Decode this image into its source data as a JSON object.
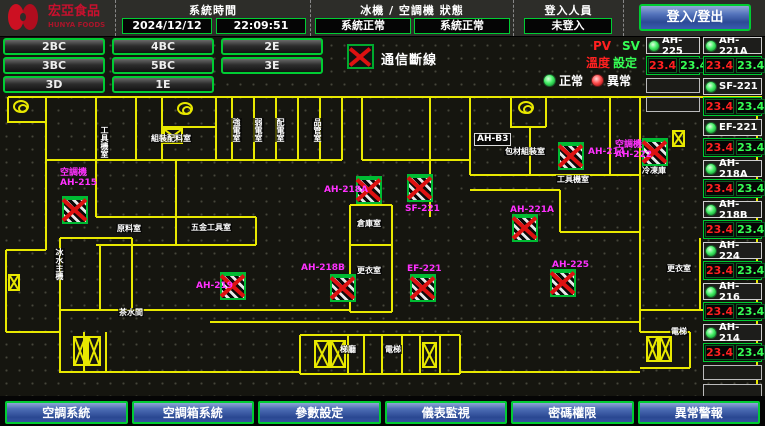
{
  "header": {
    "logo": {
      "title": "宏亞食品",
      "subtitle": "HUNYA FOODS"
    },
    "system_time": {
      "label": "系統時間",
      "date": "2024/12/12",
      "time": "22:09:51"
    },
    "machine_status": {
      "label": "冰機 / 空調機 狀態",
      "chiller_status": "系統正常",
      "ahu_status": "系統正常"
    },
    "login": {
      "label": "登入人員",
      "value": "未登入",
      "button_label": "登入/登出"
    }
  },
  "floor_nav": {
    "rows": [
      [
        "2BC",
        "4BC",
        "2E"
      ],
      [
        "3BC",
        "5BC",
        "3E"
      ],
      [
        "3D",
        "1E"
      ]
    ]
  },
  "legend": {
    "comm_loss_label": "通信斷線",
    "pv": "PV",
    "sv": "SV",
    "pv_label": "溫度",
    "sv_label": "設定",
    "normal": "正常",
    "abnormal": "異常"
  },
  "units_panel": {
    "left_column": [
      {
        "name": "AH-225",
        "pv": "23.4",
        "sv": "23.4"
      }
    ],
    "left_empty_rows": 2,
    "right_column": [
      {
        "name": "AH-221A",
        "pv": "23.4",
        "sv": "23.4"
      },
      {
        "name": "SF-221",
        "pv": "23.4",
        "sv": "23.4"
      },
      {
        "name": "EF-221",
        "pv": "23.4",
        "sv": "23.4"
      },
      {
        "name": "AH-218A",
        "pv": "23.4",
        "sv": "23.4"
      },
      {
        "name": "AH-218B",
        "pv": "23.4",
        "sv": "23.4"
      },
      {
        "name": "AH-224",
        "pv": "23.4",
        "sv": "23.4"
      },
      {
        "name": "AH-216",
        "pv": "23.4",
        "sv": "23.4"
      },
      {
        "name": "AH-214",
        "pv": "23.4",
        "sv": "23.4"
      }
    ],
    "right_empty_rows": 2
  },
  "plan": {
    "units": [
      {
        "id": "AH-215",
        "label_lines": [
          "空調機",
          "AH-215"
        ],
        "lx": 60,
        "ly": 168,
        "ix": 62,
        "iy": 196
      },
      {
        "id": "AH-219",
        "label_lines": [
          "AH-219"
        ],
        "lx": 196,
        "ly": 281,
        "ix": 220,
        "iy": 272
      },
      {
        "id": "AH-218A",
        "label_lines": [
          "AH-218A"
        ],
        "lx": 324,
        "ly": 185,
        "ix": 356,
        "iy": 176
      },
      {
        "id": "SF-221",
        "label_lines": [
          "SF-221"
        ],
        "lx": 405,
        "ly": 204,
        "ix": 407,
        "iy": 174
      },
      {
        "id": "AH-218B",
        "label_lines": [
          "AH-218B"
        ],
        "lx": 301,
        "ly": 263,
        "ix": 330,
        "iy": 274
      },
      {
        "id": "EF-221",
        "label_lines": [
          "EF-221"
        ],
        "lx": 407,
        "ly": 264,
        "ix": 410,
        "iy": 274
      },
      {
        "id": "AH-221A",
        "label_lines": [
          "AH-221A"
        ],
        "lx": 510,
        "ly": 205,
        "ix": 512,
        "iy": 214
      },
      {
        "id": "AH-225",
        "label_lines": [
          "AH-225"
        ],
        "lx": 552,
        "ly": 260,
        "ix": 550,
        "iy": 269
      },
      {
        "id": "AH-214",
        "label_lines": [
          "AH-214"
        ],
        "lx": 588,
        "ly": 147,
        "ix": 558,
        "iy": 142
      },
      {
        "id": "AH-222",
        "label_lines": [
          "空調機",
          "AH-222"
        ],
        "lx": 615,
        "ly": 140,
        "ix": 642,
        "iy": 138
      }
    ],
    "rooms": [
      {
        "text": "工具機室",
        "x": 99,
        "y": 126,
        "vertical": true
      },
      {
        "text": "組裝配料室",
        "x": 150,
        "y": 134
      },
      {
        "text": "強電室",
        "x": 231,
        "y": 118,
        "vertical": true
      },
      {
        "text": "弱電室",
        "x": 253,
        "y": 118,
        "vertical": true
      },
      {
        "text": "配電室",
        "x": 275,
        "y": 118,
        "vertical": true
      },
      {
        "text": "品管室",
        "x": 312,
        "y": 118,
        "vertical": true
      },
      {
        "text": "AH-B3",
        "x": 474,
        "y": 133,
        "boxed": true
      },
      {
        "text": "包材組裝室",
        "x": 504,
        "y": 147
      },
      {
        "text": "工具機室",
        "x": 556,
        "y": 175
      },
      {
        "text": "冷凍庫",
        "x": 641,
        "y": 166
      },
      {
        "text": "原料室",
        "x": 116,
        "y": 224
      },
      {
        "text": "五金工具室",
        "x": 190,
        "y": 223
      },
      {
        "text": "倉庫室",
        "x": 356,
        "y": 219
      },
      {
        "text": "更衣室",
        "x": 356,
        "y": 266
      },
      {
        "text": "茶水間",
        "x": 118,
        "y": 308
      },
      {
        "text": "冰水主機",
        "x": 54,
        "y": 248,
        "vertical": true
      },
      {
        "text": "梯廳",
        "x": 339,
        "y": 345
      },
      {
        "text": "電梯",
        "x": 384,
        "y": 345
      },
      {
        "text": "更衣室",
        "x": 666,
        "y": 264
      },
      {
        "text": "電梯",
        "x": 670,
        "y": 327
      }
    ],
    "stairs": [
      {
        "x": 163,
        "y": 128,
        "w": 20,
        "h": 16
      },
      {
        "x": 672,
        "y": 130,
        "w": 13,
        "h": 17
      },
      {
        "x": 8,
        "y": 274,
        "w": 12,
        "h": 17
      },
      {
        "x": 73,
        "y": 336,
        "w": 14,
        "h": 30
      },
      {
        "x": 87,
        "y": 336,
        "w": 14,
        "h": 30
      },
      {
        "x": 314,
        "y": 340,
        "w": 16,
        "h": 28
      },
      {
        "x": 330,
        "y": 340,
        "w": 16,
        "h": 28
      },
      {
        "x": 422,
        "y": 342,
        "w": 15,
        "h": 26
      },
      {
        "x": 646,
        "y": 336,
        "w": 13,
        "h": 26
      },
      {
        "x": 659,
        "y": 336,
        "w": 13,
        "h": 26
      }
    ],
    "spirals": [
      {
        "x": 13,
        "y": 100
      },
      {
        "x": 177,
        "y": 102
      },
      {
        "x": 518,
        "y": 101
      }
    ]
  },
  "footer": {
    "buttons": [
      "空調系統",
      "空調箱系統",
      "參數設定",
      "儀表監視",
      "密碼權限",
      "異常警報"
    ]
  },
  "colors": {
    "accent_green": "#00cc33",
    "alarm_red": "#dd1111",
    "magenta": "#ff30ff",
    "wall_yellow": "#e8e800",
    "button_blue": "#3a5ca8",
    "pv_red": "#ff2020",
    "sv_green": "#35ff55"
  }
}
